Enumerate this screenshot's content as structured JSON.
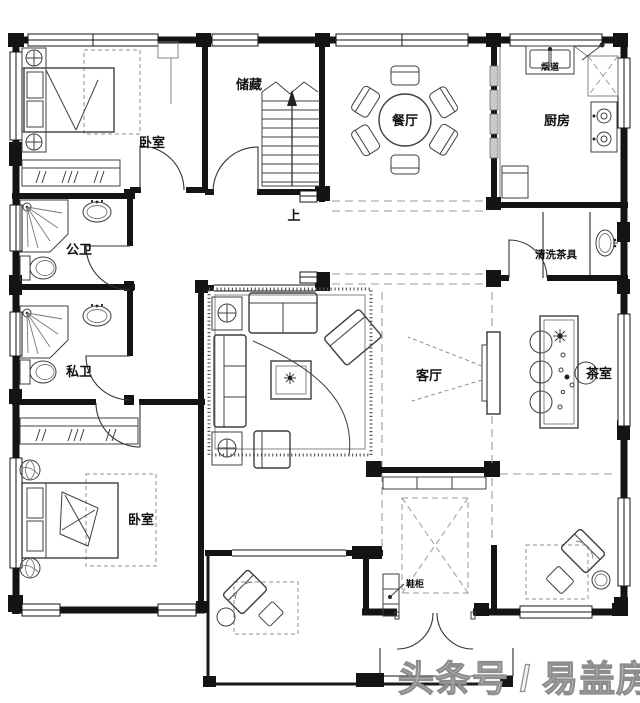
{
  "document": {
    "kind": "residential floor plan drawing",
    "language": "zh"
  },
  "rooms": {
    "bedroom_top": {
      "label": "卧室"
    },
    "storage": {
      "label": "储藏"
    },
    "dining": {
      "label": "餐厅"
    },
    "kitchen": {
      "label": "厨房"
    },
    "bath_public": {
      "label": "公卫"
    },
    "bath_private": {
      "label": "私卫"
    },
    "living": {
      "label": "客厅"
    },
    "tea_room": {
      "label": "茶室"
    },
    "bedroom_bottom": {
      "label": "卧室"
    }
  },
  "annotations": {
    "flue": {
      "label": "烟道"
    },
    "tea_wash": {
      "label": "清洗茶具"
    },
    "stairs_up": {
      "label": "上"
    },
    "shoe_cabinet": {
      "label": "鞋柜"
    }
  },
  "watermark": {
    "text": "头条号 / 易盖房"
  },
  "colors": {
    "wall": "#141414",
    "furniture": "#3f3f3f",
    "dashed_guide": "#9a9a9a",
    "watermark_stroke": "#8d8d8d",
    "background": "#ffffff"
  }
}
